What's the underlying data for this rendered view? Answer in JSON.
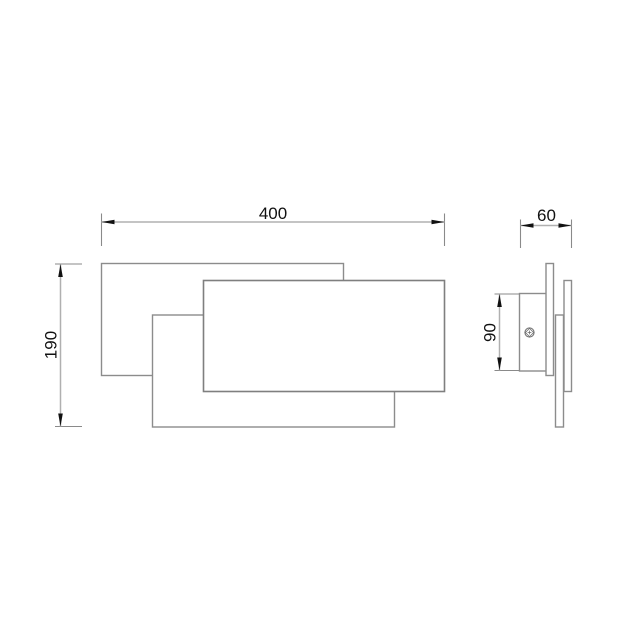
{
  "dimensions": {
    "overall_width": "400",
    "overall_height": "190",
    "overall_depth": "60",
    "backplate_height": "90"
  },
  "colors": {
    "background": "#ffffff",
    "outline": "#8c8c8c",
    "front_outline": "#7f7f7f",
    "dim_line": "#b0b0b0",
    "ext_line": "#8a8a8a",
    "arrow": "#111111",
    "text": "#111111",
    "screw": "#6e6e6e"
  },
  "icons": {
    "screw": "screw-head"
  }
}
